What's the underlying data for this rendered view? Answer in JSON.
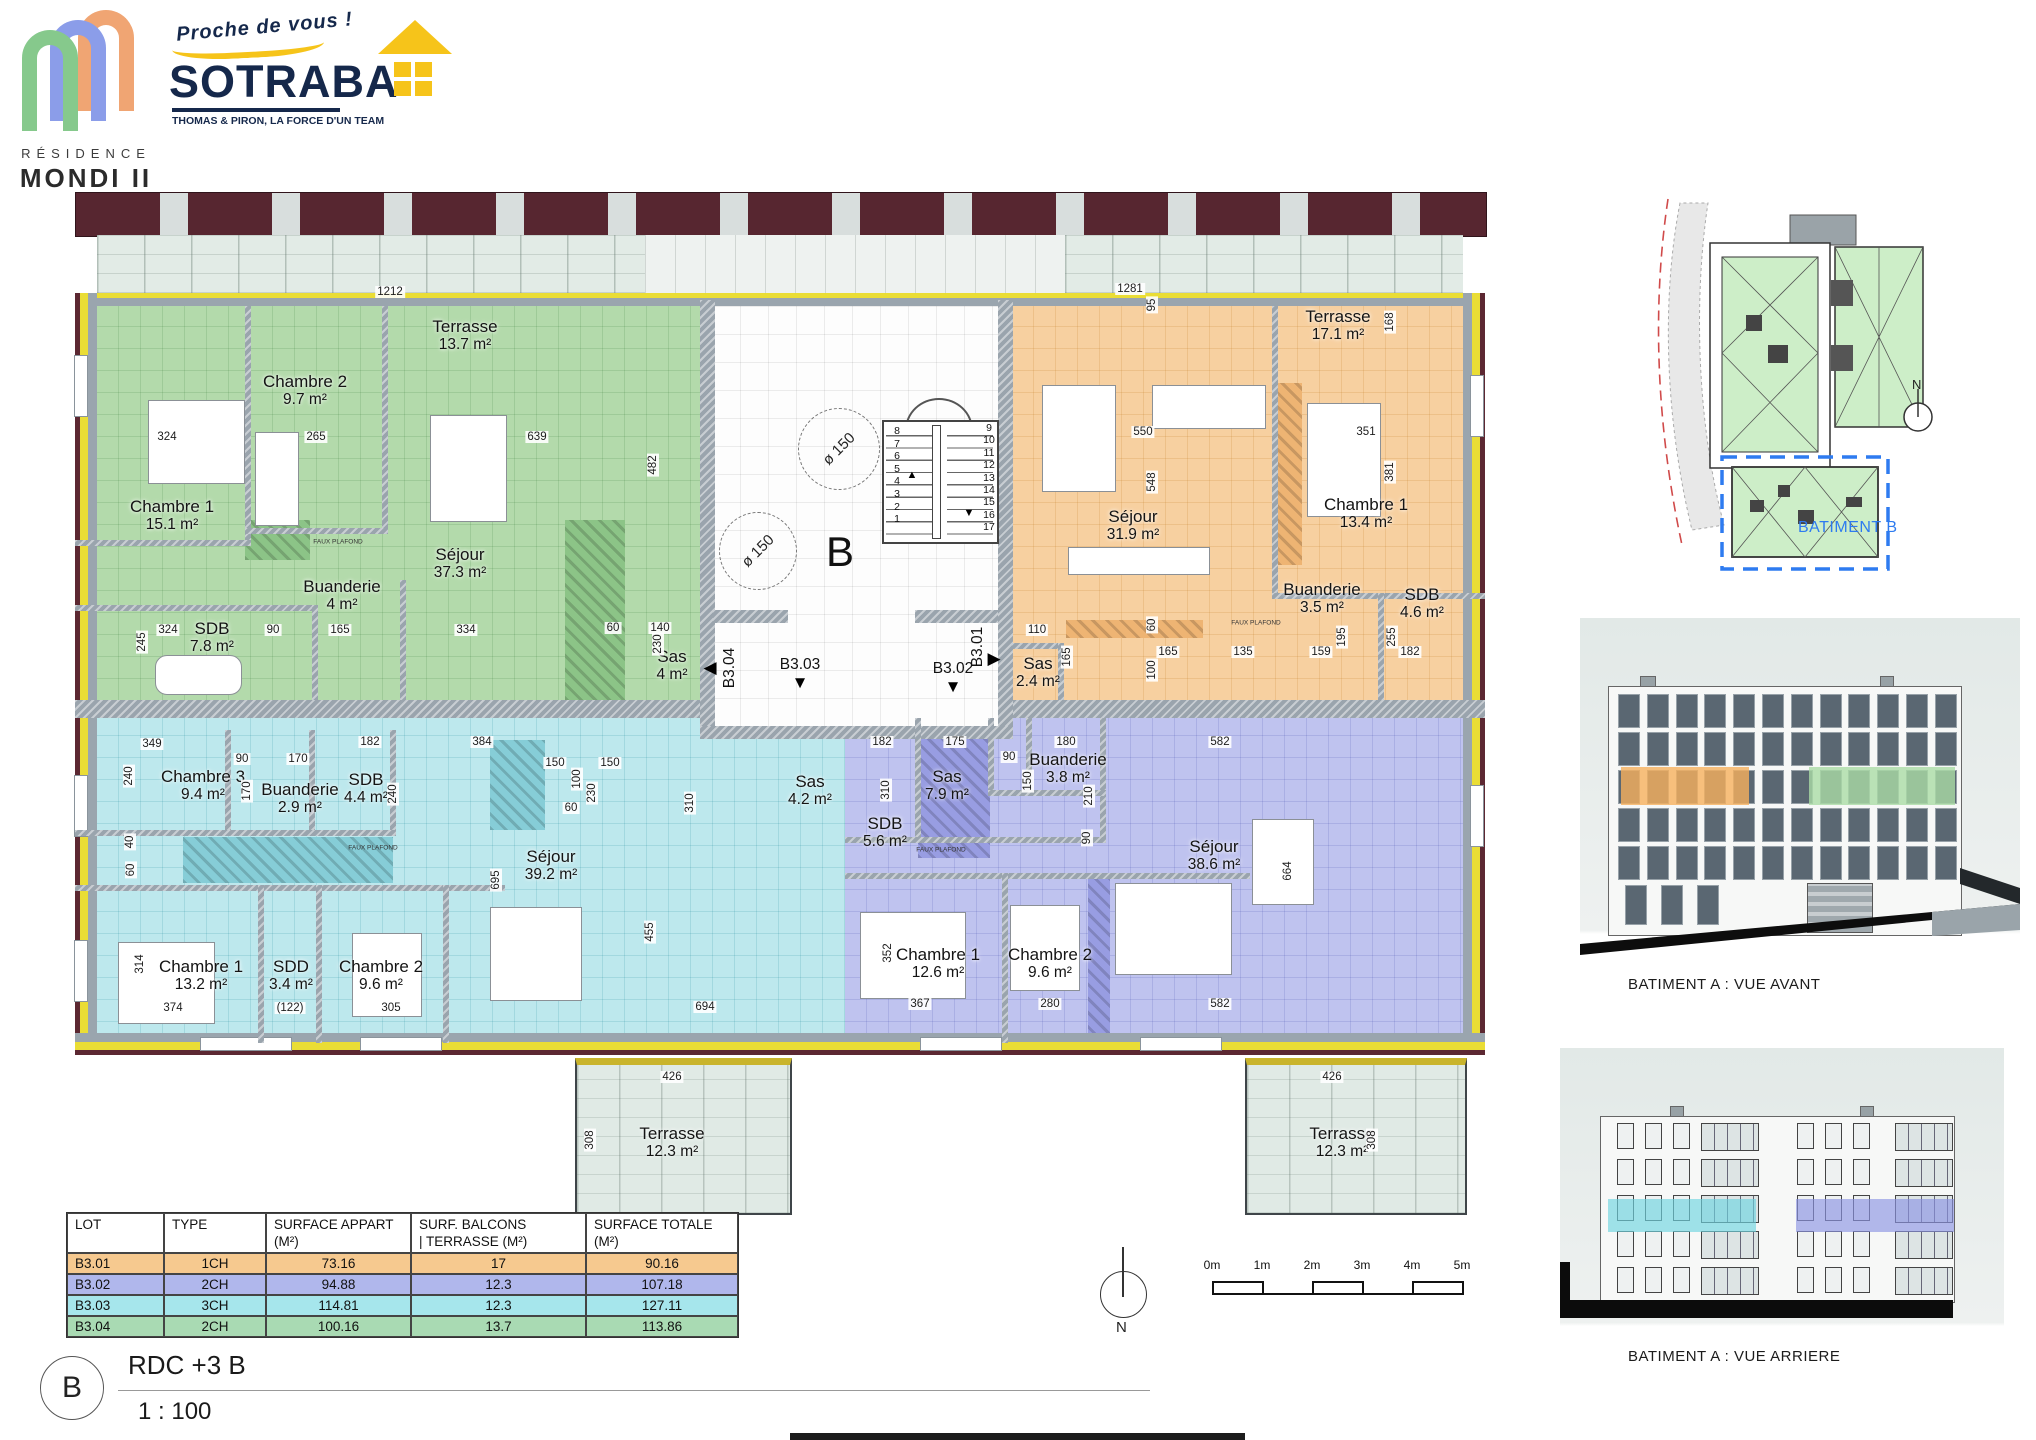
{
  "branding": {
    "residence_line1": "RÉSIDENCE",
    "residence_line2": "MONDI II",
    "tagline": "Proche de vous !",
    "company": "SOTRABA",
    "company_sub": "THOMAS & PIRON, LA FORCE D'UN TEAM"
  },
  "plan": {
    "building_letter": "B",
    "arrow_glyphs": {
      "left": "◀",
      "right": "▶",
      "down": "▼"
    },
    "stairs_up_glyph": "▲",
    "stairs_down_glyph": "▼",
    "circle_labels": [
      "ø 150",
      "ø 150"
    ],
    "stairs_left": [
      "8",
      "7",
      "6",
      "5",
      "4",
      "3",
      "2",
      "1"
    ],
    "stairs_right": [
      "9",
      "10",
      "11",
      "12",
      "13",
      "14",
      "15",
      "16",
      "17"
    ],
    "hall_units": [
      {
        "label": "B3.04",
        "arrow": "left",
        "x": 670,
        "y": 483,
        "vertical": true
      },
      {
        "label": "B3.03",
        "arrow": "down",
        "x": 740,
        "y": 480
      },
      {
        "label": "B3.02",
        "arrow": "down",
        "x": 893,
        "y": 484
      },
      {
        "label": "B3.01",
        "arrow": "right",
        "x": 918,
        "y": 462,
        "vertical": true
      }
    ],
    "rooms": [
      {
        "n": "Terrasse",
        "a": "13.7 m²",
        "x": 405,
        "y": 150
      },
      {
        "n": "Chambre 2",
        "a": "9.7 m²",
        "x": 245,
        "y": 205
      },
      {
        "n": "Chambre 1",
        "a": "15.1 m²",
        "x": 112,
        "y": 330
      },
      {
        "n": "Séjour",
        "a": "37.3 m²",
        "x": 400,
        "y": 378
      },
      {
        "n": "Buanderie",
        "a": "4 m²",
        "x": 282,
        "y": 410
      },
      {
        "n": "SDB",
        "a": "7.8 m²",
        "x": 152,
        "y": 452
      },
      {
        "n": "Sas",
        "a": "4 m²",
        "x": 612,
        "y": 480
      },
      {
        "n": "Terrasse",
        "a": "17.1 m²",
        "x": 1278,
        "y": 140
      },
      {
        "n": "Séjour",
        "a": "31.9 m²",
        "x": 1073,
        "y": 340
      },
      {
        "n": "Chambre 1",
        "a": "13.4 m²",
        "x": 1306,
        "y": 328
      },
      {
        "n": "Buanderie",
        "a": "3.5 m²",
        "x": 1262,
        "y": 413
      },
      {
        "n": "SDB",
        "a": "4.6 m²",
        "x": 1362,
        "y": 418
      },
      {
        "n": "Sas",
        "a": "2.4 m²",
        "x": 978,
        "y": 487
      },
      {
        "n": "Chambre 3",
        "a": "9.4 m²",
        "x": 143,
        "y": 600
      },
      {
        "n": "Buanderie",
        "a": "2.9 m²",
        "x": 240,
        "y": 613
      },
      {
        "n": "SDB",
        "a": "4.4 m²",
        "x": 306,
        "y": 603
      },
      {
        "n": "Séjour",
        "a": "39.2 m²",
        "x": 491,
        "y": 680
      },
      {
        "n": "Sas",
        "a": "4.2 m²",
        "x": 750,
        "y": 605
      },
      {
        "n": "Chambre 1",
        "a": "13.2 m²",
        "x": 141,
        "y": 790
      },
      {
        "n": "SDD",
        "a": "3.4 m²",
        "x": 231,
        "y": 790
      },
      {
        "n": "Chambre 2",
        "a": "9.6 m²",
        "x": 321,
        "y": 790
      },
      {
        "n": "Terrasse",
        "a": "12.3 m²",
        "x": 612,
        "y": 957
      },
      {
        "n": "SDB",
        "a": "5.6 m²",
        "x": 825,
        "y": 647
      },
      {
        "n": "Sas",
        "a": "7.9 m²",
        "x": 887,
        "y": 600
      },
      {
        "n": "Buanderie",
        "a": "3.8 m²",
        "x": 1008,
        "y": 583
      },
      {
        "n": "Séjour",
        "a": "38.6 m²",
        "x": 1154,
        "y": 670
      },
      {
        "n": "Chambre 1",
        "a": "12.6 m²",
        "x": 878,
        "y": 778
      },
      {
        "n": "Chambre 2",
        "a": "9.6 m²",
        "x": 990,
        "y": 778
      },
      {
        "n": "Terrasse",
        "a": "12.3 m²",
        "x": 1282,
        "y": 957
      }
    ],
    "dims": [
      {
        "t": "1212",
        "x": 330,
        "y": 107
      },
      {
        "t": "1281",
        "x": 1070,
        "y": 104
      },
      {
        "t": "95",
        "x": 1092,
        "y": 120,
        "v": 1
      },
      {
        "t": "168",
        "x": 1330,
        "y": 137,
        "v": 1
      },
      {
        "t": "324",
        "x": 107,
        "y": 252
      },
      {
        "t": "265",
        "x": 256,
        "y": 252
      },
      {
        "t": "639",
        "x": 477,
        "y": 252
      },
      {
        "t": "482",
        "x": 593,
        "y": 280,
        "v": 1
      },
      {
        "t": "550",
        "x": 1083,
        "y": 247
      },
      {
        "t": "548",
        "x": 1092,
        "y": 297,
        "v": 1
      },
      {
        "t": "351",
        "x": 1306,
        "y": 247
      },
      {
        "t": "381",
        "x": 1330,
        "y": 287,
        "v": 1
      },
      {
        "t": "324",
        "x": 108,
        "y": 445
      },
      {
        "t": "245",
        "x": 82,
        "y": 457,
        "v": 1
      },
      {
        "t": "90",
        "x": 213,
        "y": 445
      },
      {
        "t": "165",
        "x": 280,
        "y": 445
      },
      {
        "t": "334",
        "x": 406,
        "y": 445
      },
      {
        "t": "60",
        "x": 553,
        "y": 443
      },
      {
        "t": "140",
        "x": 600,
        "y": 443
      },
      {
        "t": "230",
        "x": 598,
        "y": 459,
        "v": 1
      },
      {
        "t": "110",
        "x": 977,
        "y": 445
      },
      {
        "t": "165",
        "x": 1007,
        "y": 472,
        "v": 1
      },
      {
        "t": "60",
        "x": 1092,
        "y": 440,
        "v": 1
      },
      {
        "t": "100",
        "x": 1092,
        "y": 485,
        "v": 1
      },
      {
        "t": "165",
        "x": 1108,
        "y": 467
      },
      {
        "t": "135",
        "x": 1183,
        "y": 467
      },
      {
        "t": "159",
        "x": 1261,
        "y": 467
      },
      {
        "t": "195",
        "x": 1282,
        "y": 452,
        "v": 1
      },
      {
        "t": "255",
        "x": 1332,
        "y": 452,
        "v": 1
      },
      {
        "t": "182",
        "x": 1350,
        "y": 467
      },
      {
        "t": "349",
        "x": 92,
        "y": 559
      },
      {
        "t": "240",
        "x": 69,
        "y": 591,
        "v": 1
      },
      {
        "t": "90",
        "x": 182,
        "y": 574
      },
      {
        "t": "170",
        "x": 238,
        "y": 574
      },
      {
        "t": "170",
        "x": 187,
        "y": 606,
        "v": 1
      },
      {
        "t": "182",
        "x": 310,
        "y": 557
      },
      {
        "t": "240",
        "x": 333,
        "y": 609,
        "v": 1
      },
      {
        "t": "384",
        "x": 422,
        "y": 557
      },
      {
        "t": "40",
        "x": 70,
        "y": 657,
        "v": 1
      },
      {
        "t": "60",
        "x": 71,
        "y": 685,
        "v": 1
      },
      {
        "t": "695",
        "x": 436,
        "y": 695,
        "v": 1
      },
      {
        "t": "150",
        "x": 495,
        "y": 578
      },
      {
        "t": "100",
        "x": 517,
        "y": 594,
        "v": 1
      },
      {
        "t": "150",
        "x": 550,
        "y": 578
      },
      {
        "t": "230",
        "x": 532,
        "y": 608,
        "v": 1
      },
      {
        "t": "60",
        "x": 511,
        "y": 623
      },
      {
        "t": "310",
        "x": 630,
        "y": 618,
        "v": 1
      },
      {
        "t": "182",
        "x": 822,
        "y": 557
      },
      {
        "t": "175",
        "x": 895,
        "y": 557
      },
      {
        "t": "90",
        "x": 949,
        "y": 572
      },
      {
        "t": "180",
        "x": 1006,
        "y": 557
      },
      {
        "t": "582",
        "x": 1160,
        "y": 557
      },
      {
        "t": "310",
        "x": 826,
        "y": 605,
        "v": 1
      },
      {
        "t": "150",
        "x": 968,
        "y": 596,
        "v": 1
      },
      {
        "t": "210",
        "x": 1029,
        "y": 611,
        "v": 1
      },
      {
        "t": "90",
        "x": 1027,
        "y": 653,
        "v": 1
      },
      {
        "t": "352",
        "x": 828,
        "y": 768,
        "v": 1
      },
      {
        "t": "367",
        "x": 860,
        "y": 819
      },
      {
        "t": "280",
        "x": 990,
        "y": 819
      },
      {
        "t": "582",
        "x": 1160,
        "y": 819
      },
      {
        "t": "664",
        "x": 1228,
        "y": 686,
        "v": 1
      },
      {
        "t": "314",
        "x": 80,
        "y": 779,
        "v": 1
      },
      {
        "t": "374",
        "x": 113,
        "y": 823
      },
      {
        "t": "(122)",
        "x": 230,
        "y": 823
      },
      {
        "t": "305",
        "x": 331,
        "y": 823
      },
      {
        "t": "694",
        "x": 645,
        "y": 822
      },
      {
        "t": "455",
        "x": 590,
        "y": 747,
        "v": 1
      },
      {
        "t": "426",
        "x": 612,
        "y": 892
      },
      {
        "t": "308",
        "x": 530,
        "y": 955,
        "v": 1
      },
      {
        "t": "426",
        "x": 1272,
        "y": 892
      },
      {
        "t": "308",
        "x": 1312,
        "y": 955,
        "v": 1
      },
      {
        "t": "FAUX PLAFOND",
        "x": 278,
        "y": 357,
        "fp": 1
      },
      {
        "t": "FAUX PLAFOND",
        "x": 313,
        "y": 663,
        "fp": 1
      },
      {
        "t": "FAUX PLAFOND",
        "x": 881,
        "y": 665,
        "fp": 1
      },
      {
        "t": "FAUX PLAFOND",
        "x": 1196,
        "y": 438,
        "fp": 1
      }
    ]
  },
  "legend_table": {
    "headers": [
      "LOT",
      "TYPE",
      "SURFACE APPART (M²)",
      "SURF. BALCONS\n| TERRASSE (M²)",
      "SURFACE TOTALE (M²)"
    ],
    "rows": [
      {
        "lot": "B3.01",
        "type": "1CH",
        "appart": "73.16",
        "balcon": "17",
        "totale": "90.16",
        "color": "#f6c98f"
      },
      {
        "lot": "B3.02",
        "type": "2CH",
        "appart": "94.88",
        "balcon": "12.3",
        "totale": "107.18",
        "color": "#b0b7ec"
      },
      {
        "lot": "B3.03",
        "type": "3CH",
        "appart": "114.81",
        "balcon": "12.3",
        "totale": "127.11",
        "color": "#a6e6ec"
      },
      {
        "lot": "B3.04",
        "type": "2CH",
        "appart": "100.16",
        "balcon": "13.7",
        "totale": "113.86",
        "color": "#a9dab3"
      }
    ]
  },
  "side_panel": {
    "site_label": "BATIMENT B",
    "site_north_letter": "N",
    "front_label": "BATIMENT A : VUE AVANT",
    "rear_label": "BATIMENT A : VUE ARRIERE"
  },
  "footer": {
    "sheet_letter": "B",
    "level_title": "RDC +3 B",
    "scale": "1 : 100",
    "scalebar_labels": [
      "0m",
      "1m",
      "2m",
      "3m",
      "4m",
      "5m"
    ],
    "north_letter": "N"
  },
  "colors": {
    "b301_orange": "#f6c98f",
    "b302_purple": "#b0b7ec",
    "b303_cyan": "#a6e6ec",
    "b304_green": "#a9dab3",
    "accent_blue": "#2e7bf0",
    "navy": "#15284b",
    "yellow": "#f6c41a"
  }
}
